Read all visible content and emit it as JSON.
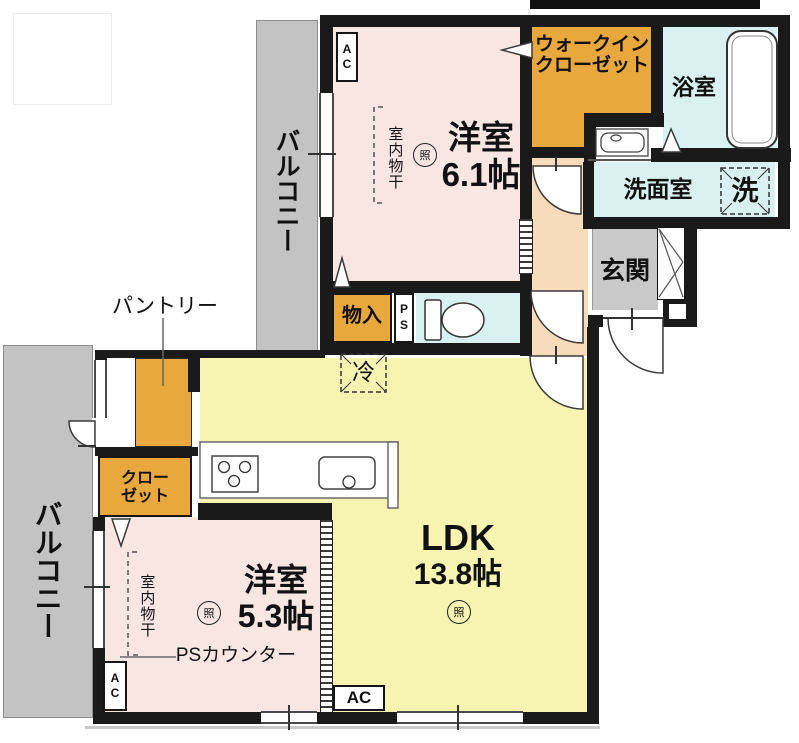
{
  "balconies": {
    "upper": "バルコニー",
    "lower": "バルコニー"
  },
  "rooms": {
    "bedroom_61": {
      "name": "洋室",
      "size": "6.1帖"
    },
    "bedroom_53": {
      "name": "洋室",
      "size": "5.3帖"
    },
    "ldk": {
      "name": "LDK",
      "size": "13.8帖"
    },
    "walk_in_closet": {
      "line1": "ウォークイン",
      "line2": "クローゼット"
    },
    "bathroom": "浴室",
    "washroom": "洗面室",
    "entrance": "玄関",
    "storage": "物入",
    "closet": {
      "line1": "クロー",
      "line2": "ゼット"
    },
    "pantry": "パントリー"
  },
  "fixtures": {
    "washer": "洗",
    "fridge": "冷",
    "pipe_space": "PS",
    "ps_counter": "PSカウンター",
    "indoor_drying": "室内物干",
    "light": "照",
    "ac": "AC"
  },
  "colors": {
    "wall": "#1a1a1a",
    "accent_orange": "#e8a83e",
    "room_pink": "#f8e6e3",
    "ldk_yellow": "#f7f3b0",
    "wet_cyan": "#d9f2f1",
    "balcony_gray": "#c3c3c3",
    "entrance_gray": "#c9c9c9",
    "hall_peach": "#f6dcba"
  }
}
